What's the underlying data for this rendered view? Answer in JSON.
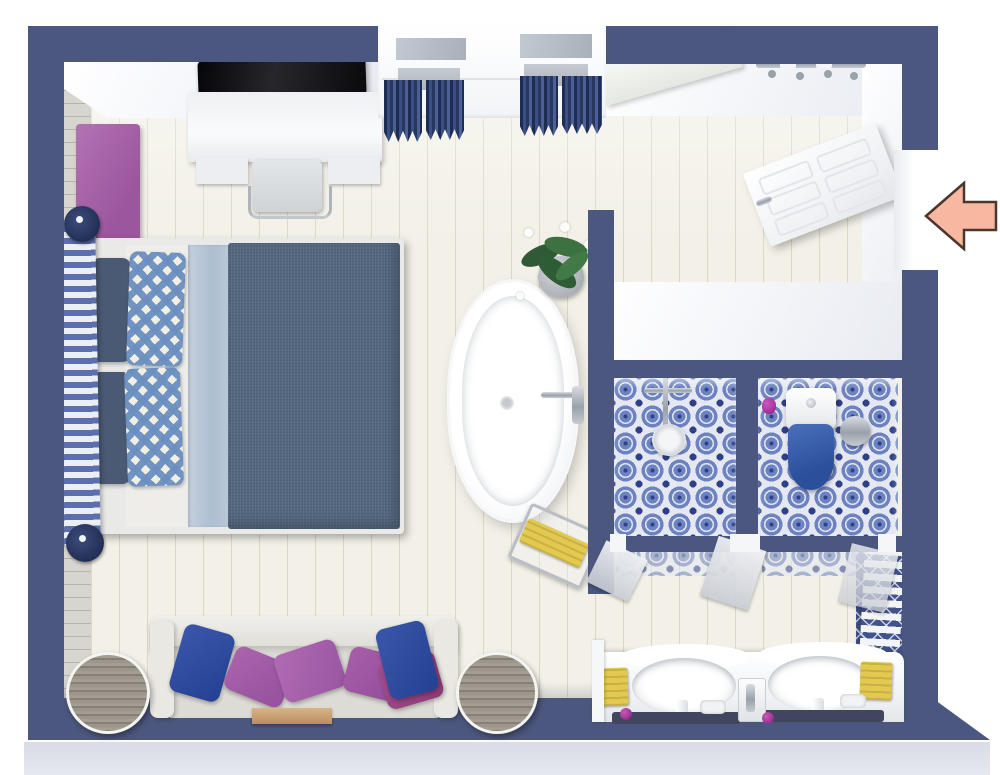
{
  "scene": {
    "type": "3d-floor-plan-render",
    "description": "Top-down 3D floor plan of a bedroom with ensuite bathroom: double bed, TV desk, window with navy curtains, freestanding bathtub, two tiled shower/WC stalls, double vanity, sofa with cushions, and an entry arrow on the right wall.",
    "visible_text": "",
    "annotation": {
      "name": "entry-arrow",
      "direction": "left",
      "meaning": "entrance into room"
    }
  },
  "colors": {
    "wall": "#4c577f",
    "wall-tile": "#42538c",
    "floor": "#f2f0e7",
    "outside-band": "#d9dbe6",
    "duvet": "#53677f",
    "sheet-blue": "#b7c6d7",
    "pillow-navy": "#4a5a74",
    "check-blue": "#6b8fc0",
    "bench-purple": "#a566a6",
    "pillow-purple": "#a158a5",
    "pillow-magenta": "#97417f",
    "pillow-blue": "#2e4da0",
    "sofa-white": "#e7e6e1",
    "sofa-seat": "#dcdbd5",
    "table-gray": "#948e85",
    "tray-tan": "#c8a277",
    "toilet-blue": "#3c60ac",
    "towel-yellow": "#e3c94f",
    "arrow-fill": "#f8b7a1",
    "arrow-stroke": "#4a372c",
    "tv-black": "#16161a",
    "plant-green": "#35603a",
    "pot-gray": "#b9bdc2",
    "soap-purple": "#93308f"
  },
  "rooms": [
    {
      "name": "bedroom",
      "features": [
        "double-bed",
        "tv-desk",
        "purple-bench",
        "sofa",
        "side-tables",
        "window-curtains"
      ]
    },
    {
      "name": "ensuite-bathroom",
      "features": [
        "freestanding-bathtub",
        "shower-stall",
        "wc-stall",
        "double-vanity",
        "towel-radiator"
      ]
    }
  ],
  "furniture": [
    "tv",
    "desk",
    "desk-chair",
    "purple-bench",
    "bed-headboard",
    "double-bed",
    "checkered-pillows",
    "bathtub",
    "orchid-plant",
    "towel-rail",
    "shower-fixture",
    "toilet",
    "waste-bin",
    "double-vanity-sinks",
    "yellow-towels",
    "towel-radiator",
    "sofa",
    "throw-pillows",
    "wooden-tray",
    "round-side-table-left",
    "round-side-table-right",
    "wall-shelf",
    "towel-hooks",
    "entry-door"
  ]
}
